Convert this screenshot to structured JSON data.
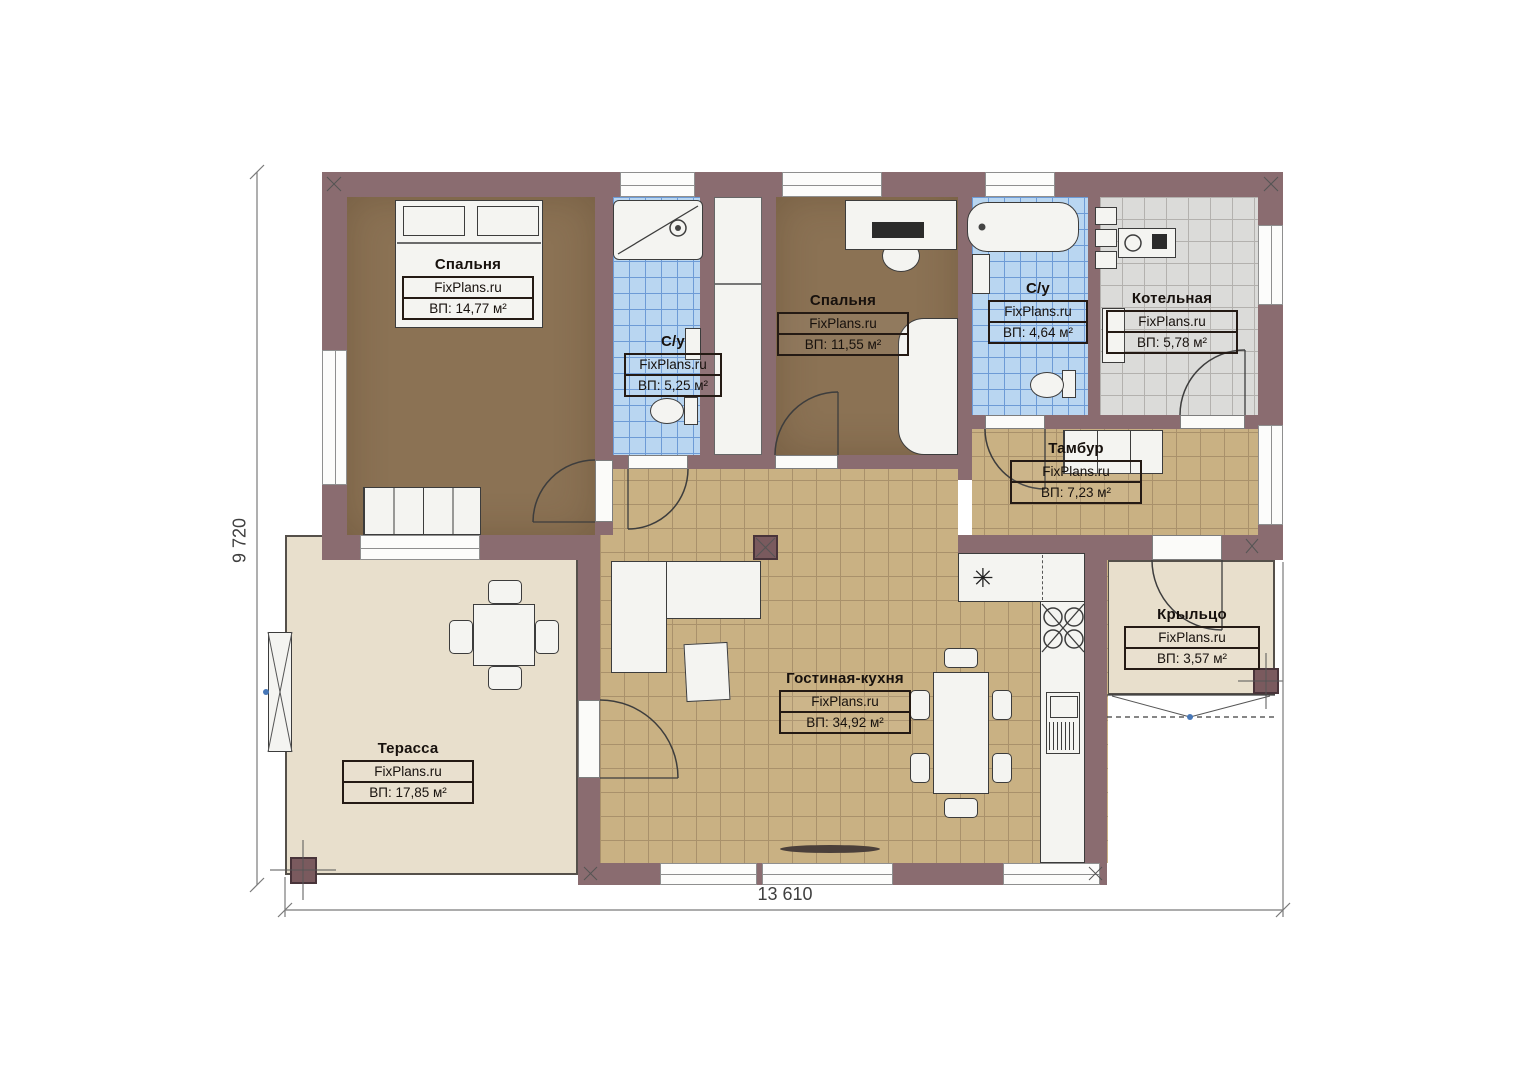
{
  "plan": {
    "width_dimension": "13 610",
    "height_dimension": "9 720"
  },
  "rooms": {
    "bedroom1": {
      "name": "Спальня",
      "brand": "FixPlans.ru",
      "area": "ВП: 14,77 м²"
    },
    "bath1": {
      "name": "С/у",
      "brand": "FixPlans.ru",
      "area": "ВП: 5,25 м²"
    },
    "bedroom2": {
      "name": "Спальня",
      "brand": "FixPlans.ru",
      "area": "ВП: 11,55 м²"
    },
    "bath2": {
      "name": "С/у",
      "brand": "FixPlans.ru",
      "area": "ВП: 4,64 м²"
    },
    "boiler": {
      "name": "Котельная",
      "brand": "FixPlans.ru",
      "area": "ВП: 5,78 м²"
    },
    "vestibule": {
      "name": "Тамбур",
      "brand": "FixPlans.ru",
      "area": "ВП: 7,23 м²"
    },
    "living_kitchen": {
      "name": "Гостиная-кухня",
      "brand": "FixPlans.ru",
      "area": "ВП: 34,92 м²"
    },
    "terrace": {
      "name": "Терасса",
      "brand": "FixPlans.ru",
      "area": "ВП: 17,85 м²"
    },
    "porch": {
      "name": "Крыльцо",
      "brand": "FixPlans.ru",
      "area": "ВП: 3,57 м²"
    }
  },
  "symbols": {
    "fridge": "✳"
  },
  "colors": {
    "wall": "#8a6c70",
    "bedroom_floor": "#8b7254",
    "bath_tile": "#b9d6f1",
    "boiler_tile": "#dbdbd9",
    "living_tile": "#c9b183",
    "terrace_floor": "#e8dfcc"
  }
}
